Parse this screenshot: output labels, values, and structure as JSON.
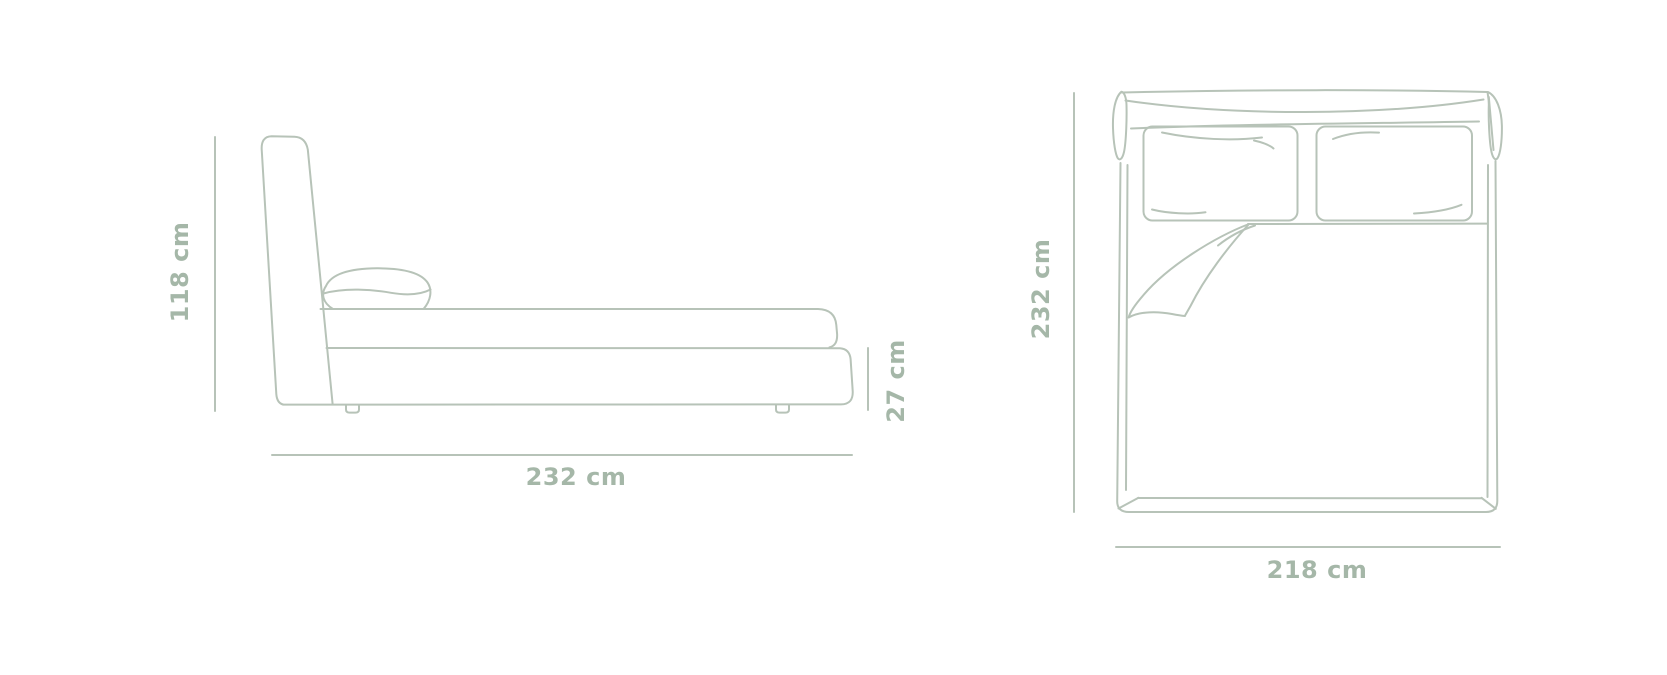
{
  "style": {
    "background_color": "#ffffff",
    "line_color": "#b7c3b8",
    "label_color": "#a5b7a8"
  },
  "diagram": {
    "side_view": {
      "height_label": "118 cm",
      "length_label": "232 cm",
      "base_height_label": "27 cm"
    },
    "top_view": {
      "depth_label": "232 cm",
      "width_label": "218 cm"
    }
  }
}
